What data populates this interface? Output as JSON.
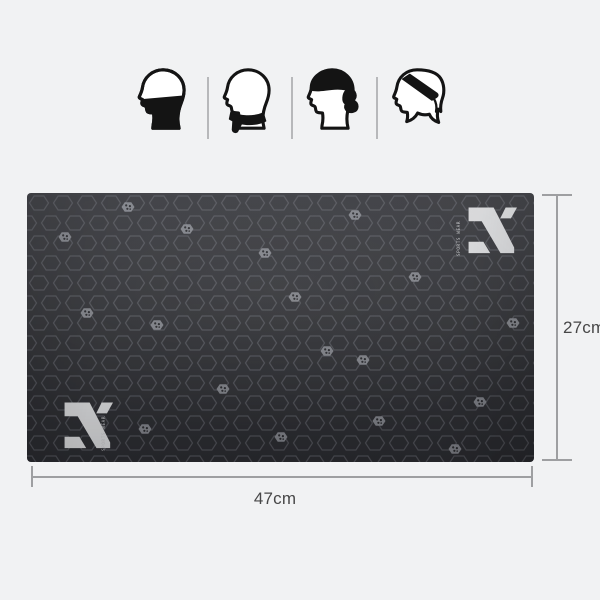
{
  "colors": {
    "background": "#f1f2f3",
    "fabric_base": "#34353a",
    "hex_outline": "#64666d",
    "icon_ink": "#141414",
    "divider": "#b7b8ba",
    "measure_line": "#9e9fa1",
    "measure_text": "#474747",
    "logo": "#d8d9db"
  },
  "usage_icons": {
    "items": [
      {
        "icon": "face-mask-icon"
      },
      {
        "icon": "neck-scarf-icon"
      },
      {
        "icon": "pirate-cap-icon"
      },
      {
        "icon": "headband-icon"
      }
    ]
  },
  "brand": {
    "logo_icon": "x-logo-mark",
    "microtext": "SPORTS WEAR"
  },
  "dimensions": {
    "height": "27cm",
    "width": "47cm"
  },
  "pattern": {
    "glyph_icon": "pinwheel-dots-hex",
    "glyph_positions": [
      [
        101,
        14
      ],
      [
        160,
        36
      ],
      [
        328,
        22
      ],
      [
        238,
        60
      ],
      [
        388,
        84
      ],
      [
        38,
        44
      ],
      [
        268,
        104
      ],
      [
        130,
        132
      ],
      [
        300,
        158
      ],
      [
        60,
        120
      ],
      [
        486,
        130
      ],
      [
        196,
        196
      ],
      [
        352,
        228
      ],
      [
        118,
        236
      ],
      [
        254,
        244
      ],
      [
        453,
        209
      ],
      [
        428,
        256
      ],
      [
        336,
        167
      ]
    ]
  }
}
